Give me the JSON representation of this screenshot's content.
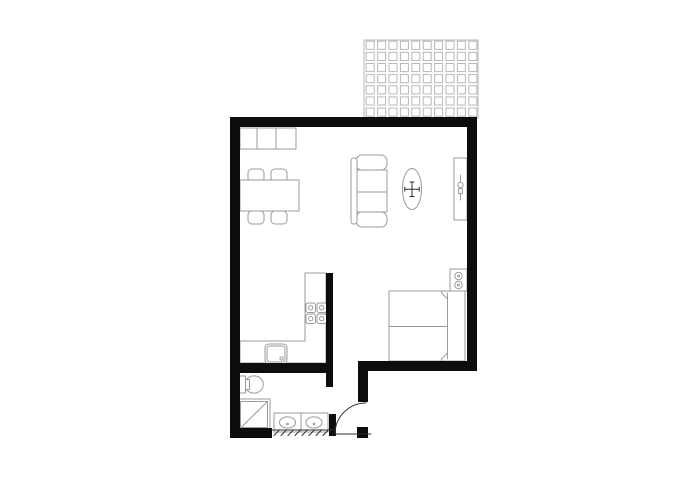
{
  "colors": {
    "background": "#ffffff",
    "wall": "#0d0d0d",
    "furniture_line": "#9b9b9b",
    "tile_line": "#b7b7b7",
    "detail_line": "#2f2f2f"
  },
  "balcony": {
    "rows": 7,
    "cols": 10
  },
  "legend": {
    "balcony": "balcony-tile-grid",
    "living_area": [
      "wardrobe-cabinet",
      "dining-table",
      "dining-chair",
      "sofa",
      "oval-ceiling-light",
      "tv-cabinet"
    ],
    "kitchen": [
      "l-shaped-counter",
      "cooktop-4-burners",
      "kitchen-sink"
    ],
    "bedroom": [
      "double-bed",
      "nightstand-with-lamp"
    ],
    "bathroom": [
      "toilet",
      "shower-tray",
      "double-sink-vanity"
    ],
    "entry": [
      "entry-door-swing",
      "threshold-line",
      "hatched-wall-segment"
    ]
  }
}
